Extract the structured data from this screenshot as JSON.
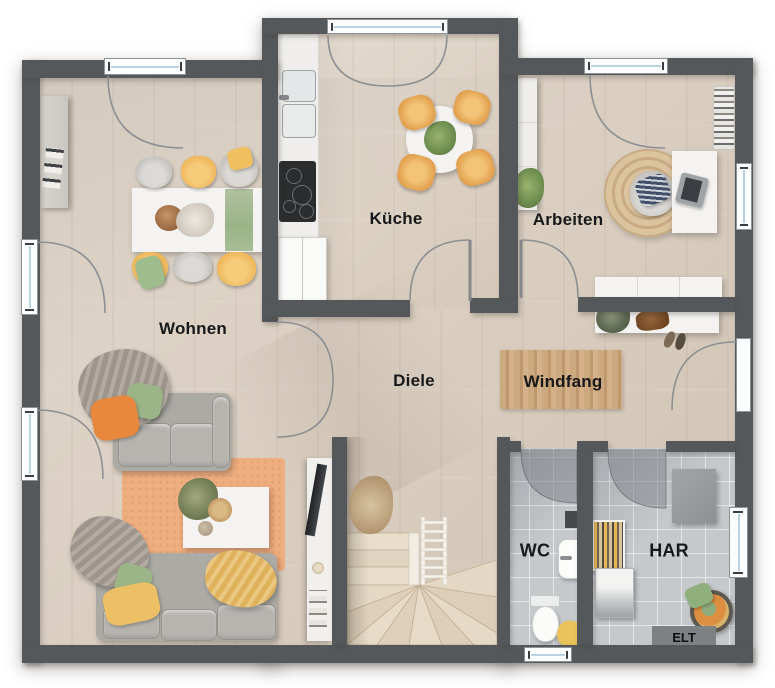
{
  "plan": {
    "type": "floor-plan",
    "rooms": {
      "wohnen": {
        "label": "Wohnen"
      },
      "kueche": {
        "label": "Küche"
      },
      "arbeiten": {
        "label": "Arbeiten"
      },
      "diele": {
        "label": "Diele"
      },
      "windfang": {
        "label": "Windfang"
      },
      "wc": {
        "label": "WC"
      },
      "har": {
        "label": "HAR"
      }
    },
    "annotations": {
      "elt": "ELT"
    },
    "colors": {
      "wall": "#55585b",
      "wood_floor": "#d9cdbe",
      "tile_floor": "#c6c9cc",
      "accent_yellow": "#eebb5f",
      "accent_green": "#9dbb8b",
      "accent_orange": "#e8883c",
      "rug_orange": "#efae80",
      "rug_jute": "#d6bd97",
      "rug_windfang": "#c8a47c",
      "window_glass": "#b9d3e2"
    }
  }
}
